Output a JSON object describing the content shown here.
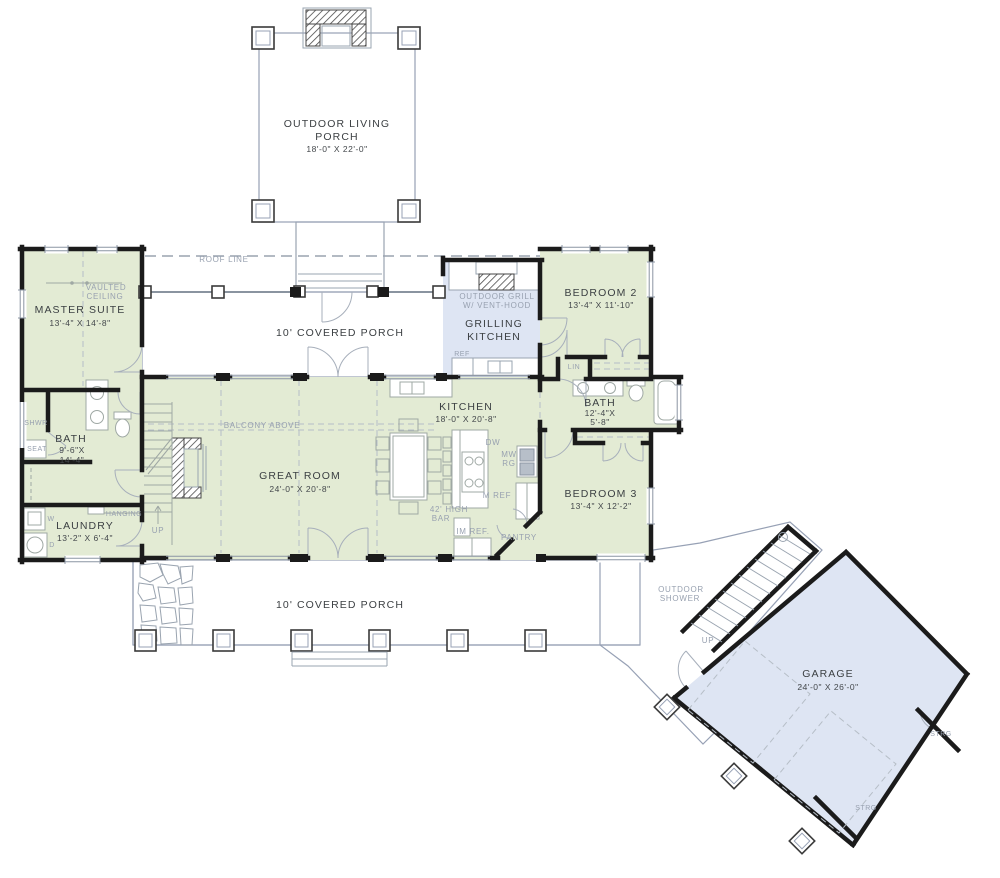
{
  "plan": {
    "colors": {
      "room_fill": "#e3ebd4",
      "porch_fill": "#dee5f3",
      "wall": "#1b1b1b",
      "note": "#98a1b0",
      "text": "#3c4043"
    },
    "rooms": {
      "outdoor_living_porch": {
        "line1": "OUTDOOR LIVING",
        "line2": "PORCH",
        "dims": "18'-0\" X 22'-0\""
      },
      "covered_porch_top": {
        "name": "10' COVERED PORCH"
      },
      "grilling_kitchen": {
        "line1": "GRILLING",
        "line2": "KITCHEN"
      },
      "master_suite": {
        "name": "MASTER SUITE",
        "dims": "13'-4\" X 14'-8\""
      },
      "master_bath": {
        "name": "BATH",
        "dims1": "9'-6\"X",
        "dims2": "14'-4\""
      },
      "laundry": {
        "name": "LAUNDRY",
        "dims": "13'-2\" X 6'-4\""
      },
      "great_room": {
        "name": "GREAT ROOM",
        "dims": "24'-0\" X 20'-8\""
      },
      "kitchen": {
        "name": "KITCHEN",
        "dims": "18'-0\" X 20'-8\""
      },
      "bedroom2": {
        "name": "BEDROOM 2",
        "dims": "13'-4\" X 11'-10\""
      },
      "bath2": {
        "name": "BATH",
        "dims1": "12'-4\"X",
        "dims2": "5'-8\""
      },
      "bedroom3": {
        "name": "BEDROOM 3",
        "dims": "13'-4\" X 12'-2\""
      },
      "covered_porch_bottom": {
        "name": "10' COVERED PORCH"
      },
      "garage": {
        "name": "GARAGE",
        "dims": "24'-0\" X 26'-0\""
      }
    },
    "notes": {
      "roof_line": "ROOF LINE",
      "vaulted1": "VAULTED",
      "vaulted2": "CEILING",
      "balcony": "BALCONY ABOVE",
      "grill1": "OUTDOOR GRILL",
      "grill2": "W/ VENT-HOOD",
      "grill_ref": "REF",
      "shwr": "SHWR",
      "seat": "SEAT",
      "washer": "W",
      "dryer": "D",
      "hanging": "HANGING",
      "up_main": "UP",
      "up_garage": "UP",
      "dw": "DW",
      "mw": "MW",
      "rg": "RG",
      "m_ref": "M REF",
      "im_ref": "IM REF.",
      "pantry": "PANTRY",
      "bar1": "42' HIGH",
      "bar2": "BAR",
      "lin": "LIN",
      "shower1": "OUTDOOR",
      "shower2": "SHOWER",
      "strg1": "STRG",
      "strg2": "STRG"
    }
  }
}
